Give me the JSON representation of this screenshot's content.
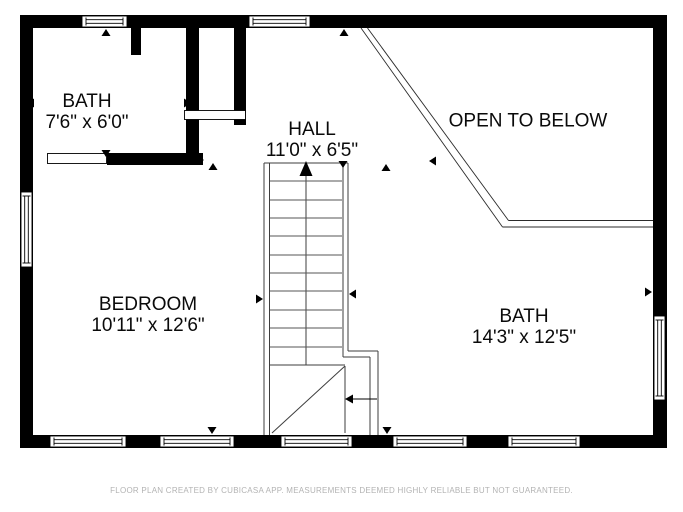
{
  "rooms": [
    {
      "name": "BATH",
      "dimensions": "7'6\" x 6'0\""
    },
    {
      "name": "HALL",
      "dimensions": "11'0\" x 6'5\""
    },
    {
      "name": "OPEN TO BELOW",
      "dimensions": ""
    },
    {
      "name": "BEDROOM",
      "dimensions": "10'11\" x 12'6\""
    },
    {
      "name": "BATH",
      "dimensions": "14'3\" x 12'5\""
    }
  ],
  "footer": {
    "disclaimer": "FLOOR PLAN CREATED BY CUBICASA APP. MEASUREMENTS DEEMED HIGHLY RELIABLE BUT NOT GUARANTEED."
  },
  "colors": {
    "wall": "#000000",
    "stair_lines": "#3d3d3d",
    "label_text": "#0a0a0a",
    "footer_text": "#b3b3b3",
    "background": "#ffffff"
  }
}
